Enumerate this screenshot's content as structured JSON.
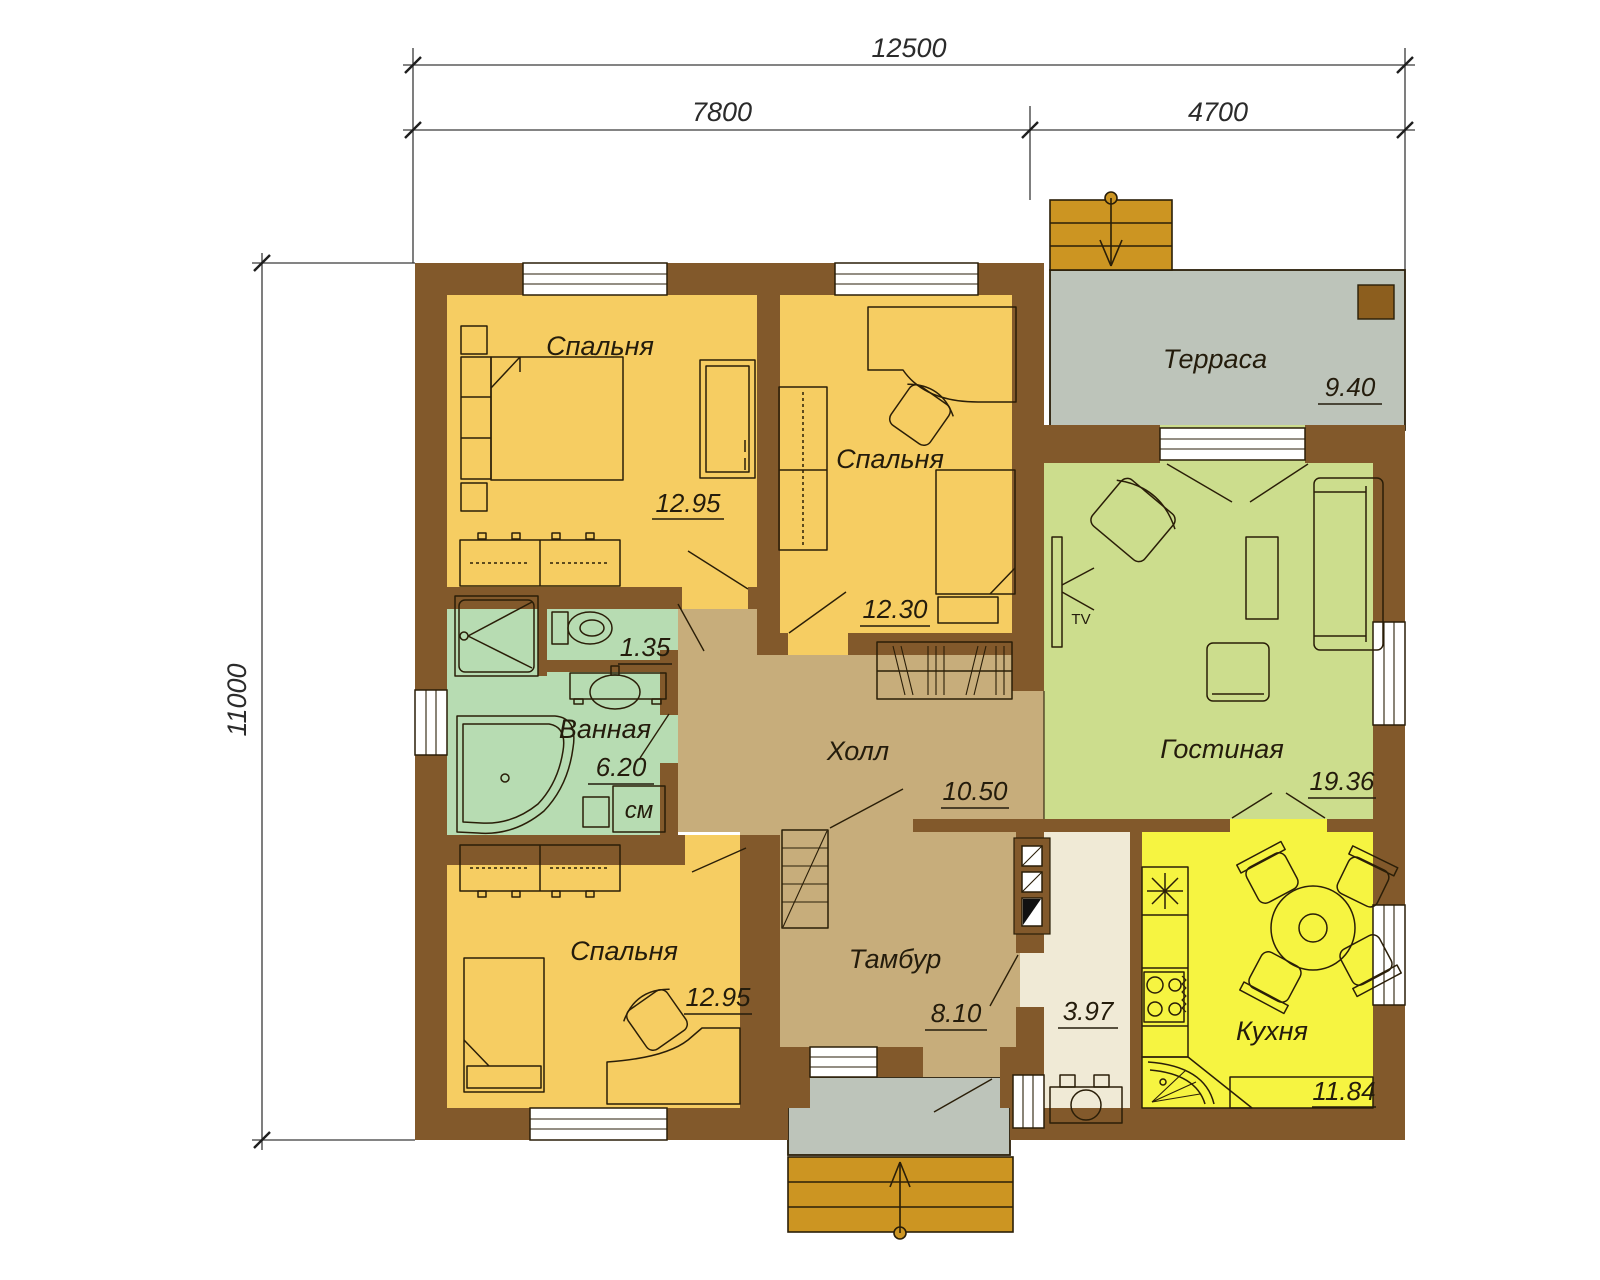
{
  "dimensions": {
    "overall_width": "12500",
    "left_span": "7800",
    "right_span": "4700",
    "overall_depth": "11000"
  },
  "rooms": [
    {
      "id": "bedroom-top-left",
      "label": "Спальня",
      "area": "12.95"
    },
    {
      "id": "bedroom-top-middle",
      "label": "Спальня",
      "area": "12.30"
    },
    {
      "id": "terrace",
      "label": "Терраса",
      "area": "9.40"
    },
    {
      "id": "living-room",
      "label": "Гостиная",
      "area": "19.36"
    },
    {
      "id": "wc",
      "label": "",
      "area": "1.35"
    },
    {
      "id": "bathroom",
      "label": "Ванная",
      "area": "6.20"
    },
    {
      "id": "hall",
      "label": "Холл",
      "area": "10.50"
    },
    {
      "id": "bedroom-bottom",
      "label": "Спальня",
      "area": "12.95"
    },
    {
      "id": "vestibule",
      "label": "Тамбур",
      "area": "8.10"
    },
    {
      "id": "utility",
      "label": "",
      "area": "3.97"
    },
    {
      "id": "kitchen",
      "label": "Кухня",
      "area": "11.84"
    }
  ],
  "labels": {
    "tv": "TV",
    "washing_machine": "см"
  },
  "colors": {
    "wall": "#82592B",
    "bedroom": "#F6CD62",
    "kitchen": "#F6F441",
    "living": "#CCDD8D",
    "bath": "#B7DCB2",
    "hall": "#C7AD7B",
    "utility": "#F0EAD6",
    "terrace": "#BDC4BA",
    "steps": "#CC9522",
    "post": "#8C5E1E"
  }
}
